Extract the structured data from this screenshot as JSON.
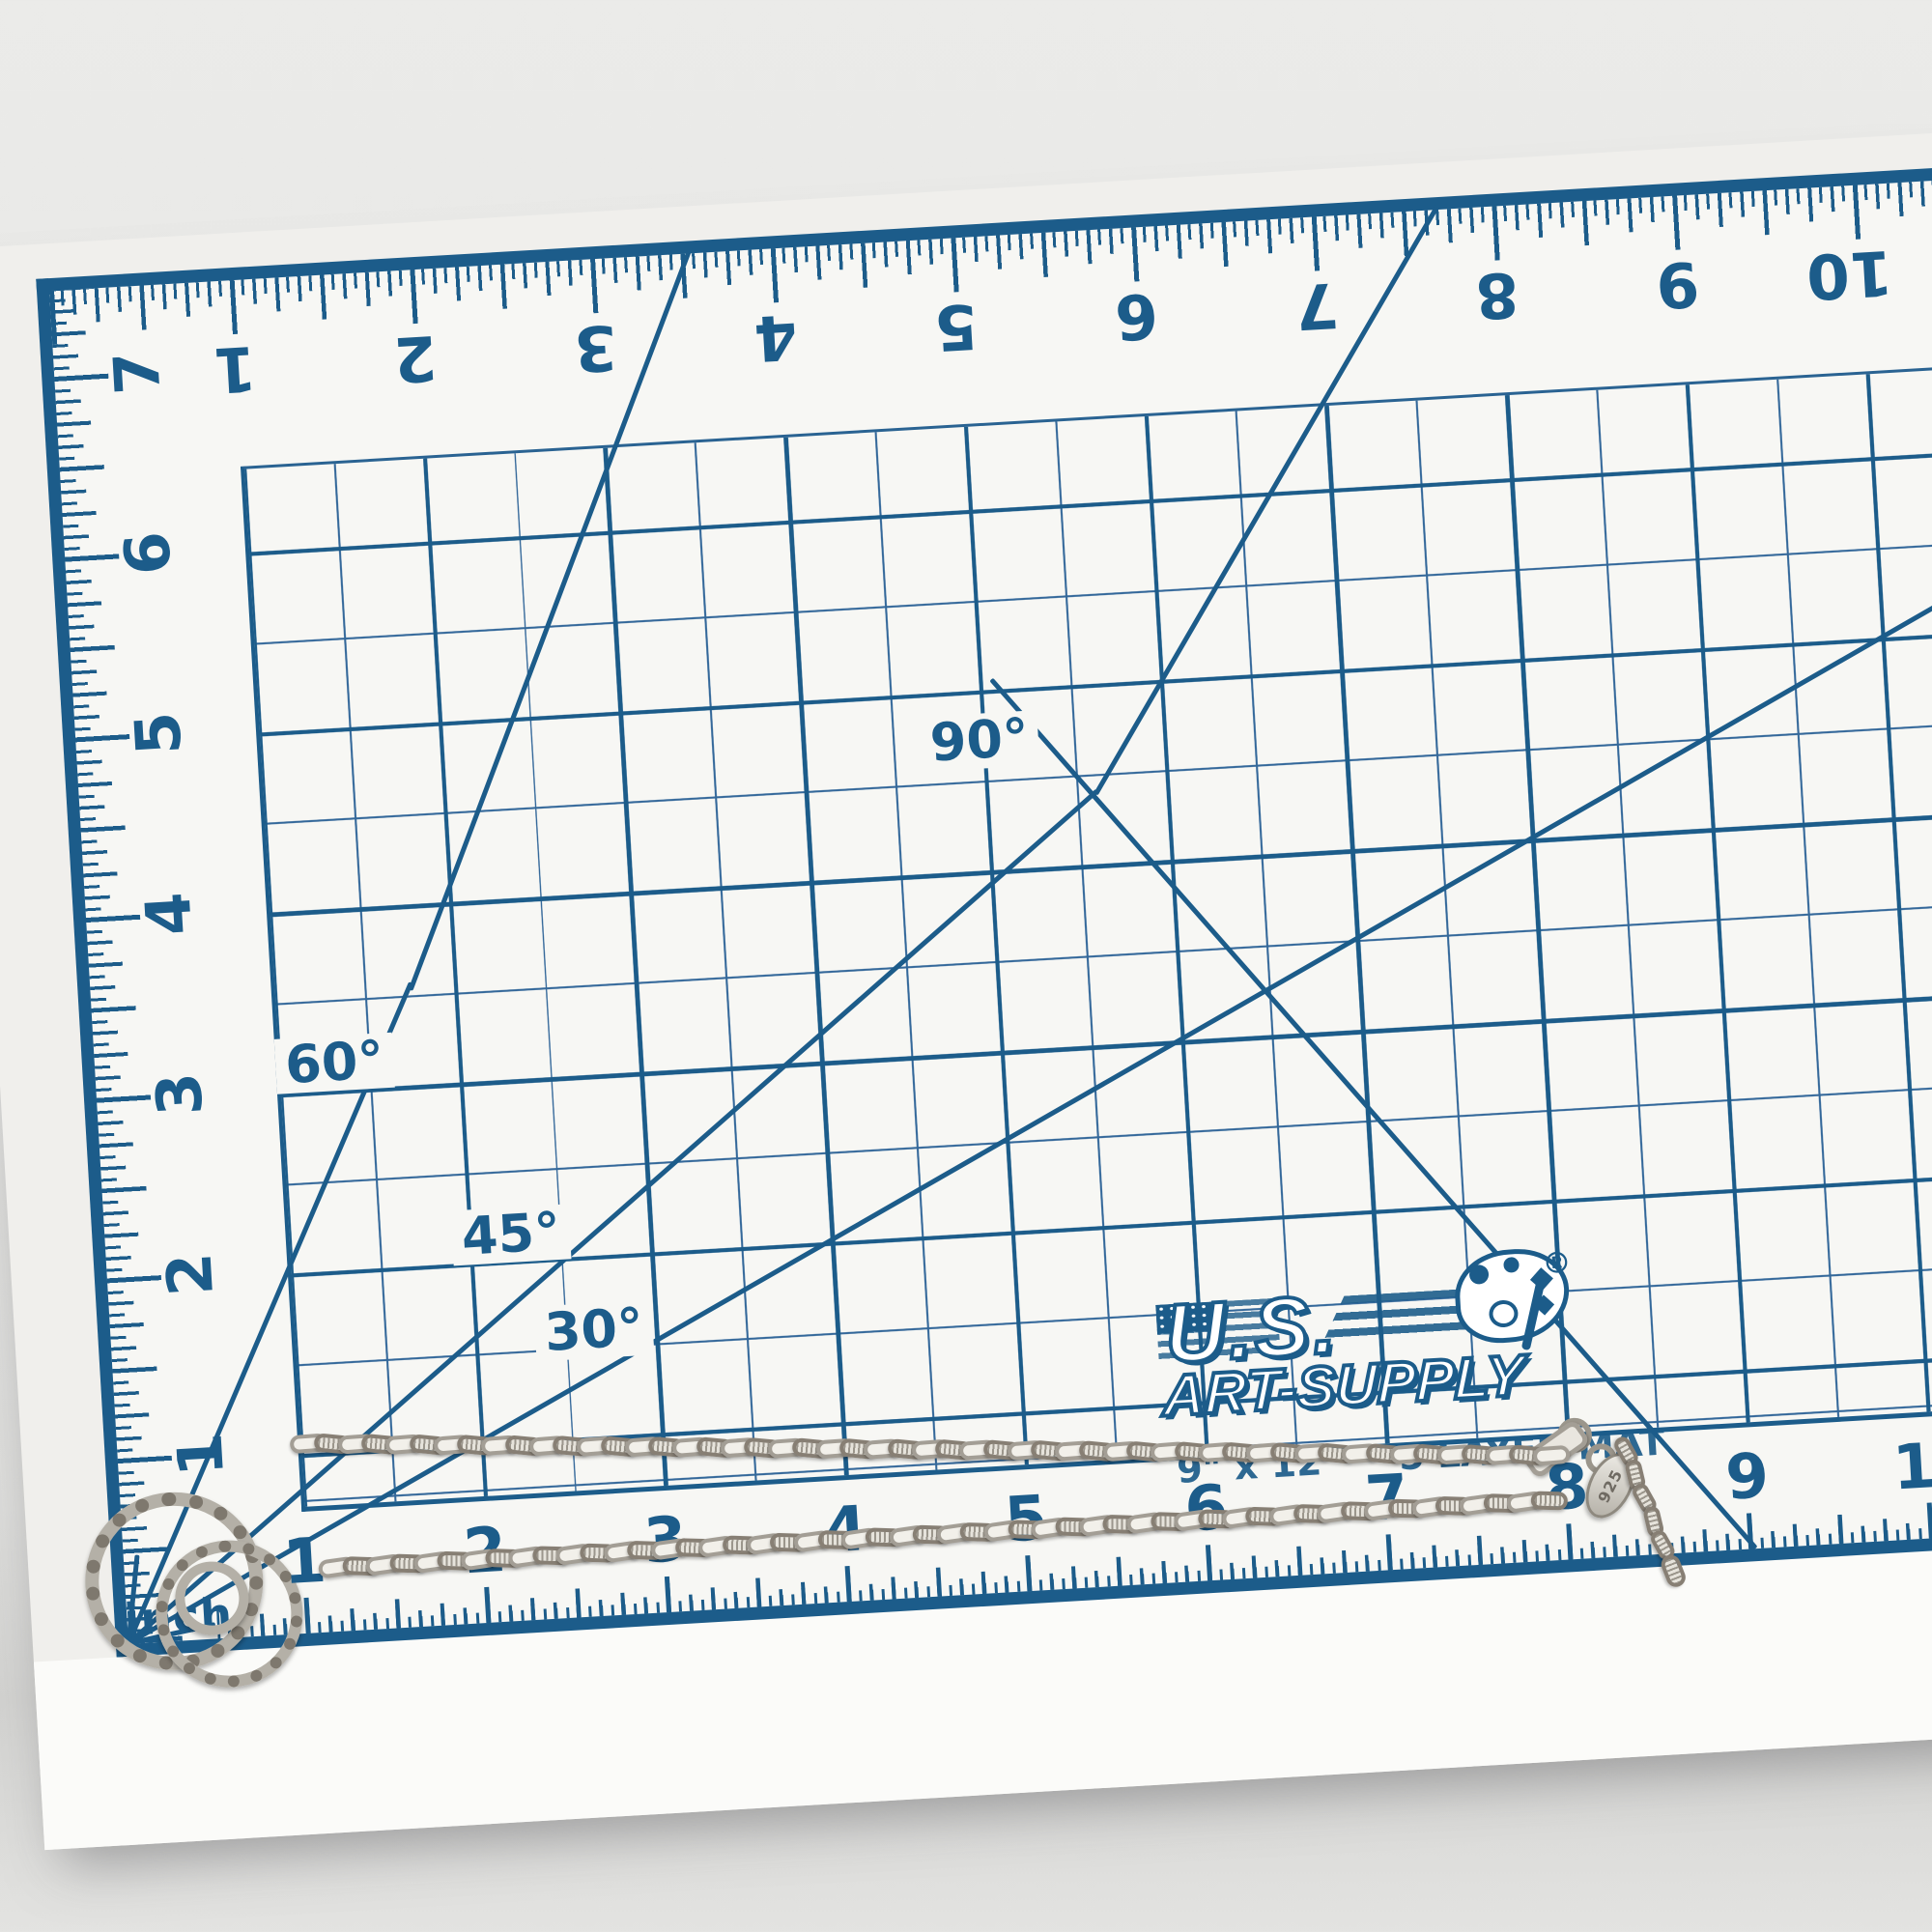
{
  "scene": {
    "description": "Photograph of a silver paperclip-link chain with rope-textured toggle rings laid across an upside-down blue-and-white cutting mat"
  },
  "mat": {
    "brand_line1": "U.S.",
    "brand_line2": "ART-SUPPLY",
    "registered": "®",
    "size_text": "9\" x 12\"",
    "type_text": "5 LAYER MAT",
    "unit_label": "inch",
    "top_numbers": [
      "1",
      "2",
      "3",
      "4",
      "5",
      "6",
      "7",
      "8",
      "9",
      "10"
    ],
    "left_numbers": [
      "7",
      "6",
      "5",
      "4",
      "3",
      "2",
      "1"
    ],
    "bottom_numbers": [
      "1",
      "2",
      "3",
      "4",
      "5",
      "6",
      "7",
      "8",
      "9",
      "10"
    ],
    "angles": {
      "deg30": "30°",
      "deg45": "45°",
      "deg60": "60°",
      "deg90": "90°"
    },
    "colors": {
      "print_blue": "#1c5c8a",
      "grid_thin_blue": "#34689a",
      "mat_white": "#f7f7f4"
    }
  },
  "jewelry": {
    "tag_text": "925",
    "strand1_links": 53,
    "strand2_links": 52,
    "extender_links": 5,
    "colors": {
      "silver_light": "#ece9e2",
      "silver_mid": "#b7b3aa",
      "silver_dark": "#8e897f"
    }
  }
}
